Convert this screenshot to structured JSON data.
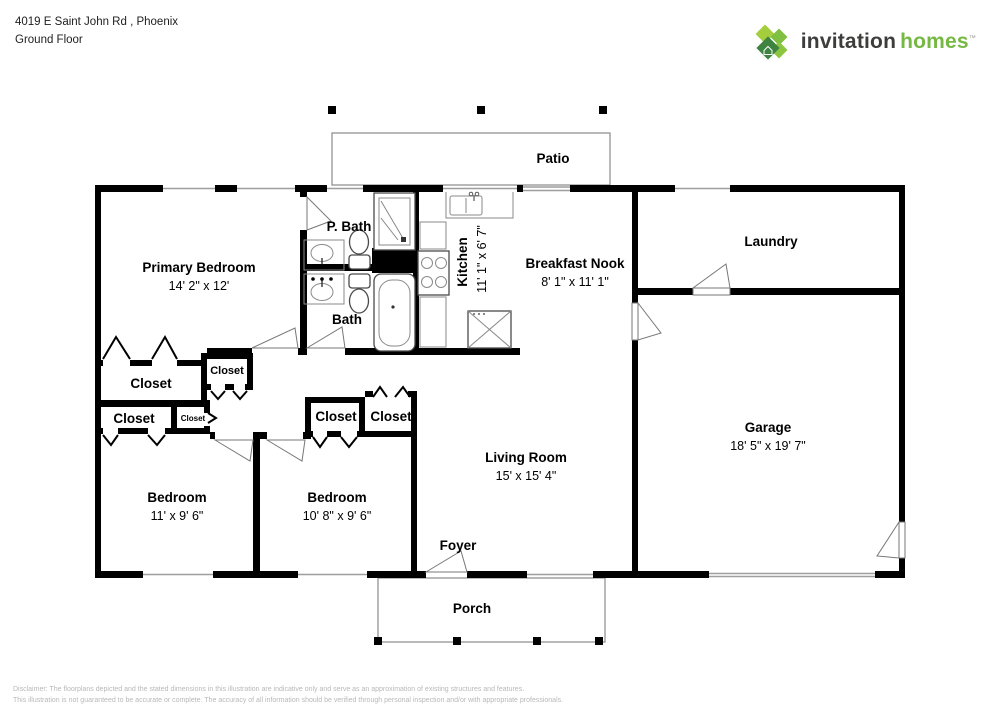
{
  "header": {
    "address_line1": "4019 E Saint John Rd , Phoenix",
    "address_line2": "Ground Floor"
  },
  "brand": {
    "name_part1": "invitation",
    "name_part2": "homes",
    "trademark": "™",
    "color_dark": "#3D3D3C",
    "color_green": "#76B844"
  },
  "plan": {
    "patio": {
      "label": "Patio"
    },
    "primary_bedroom": {
      "label": "Primary Bedroom",
      "dims": "14' 2\" x 12'"
    },
    "p_bath": {
      "label": "P. Bath"
    },
    "bath": {
      "label": "Bath"
    },
    "kitchen": {
      "label": "Kitchen",
      "dims": "11' 1\" x 6' 7\""
    },
    "breakfast_nook": {
      "label": "Breakfast Nook",
      "dims": "8' 1\" x 11' 1\""
    },
    "laundry": {
      "label": "Laundry"
    },
    "garage": {
      "label": "Garage",
      "dims": "18' 5\" x 19' 7\""
    },
    "living_room": {
      "label": "Living Room",
      "dims": "15' x 15' 4\""
    },
    "foyer": {
      "label": "Foyer"
    },
    "bedroom_2": {
      "label": "Bedroom",
      "dims": "11' x 9' 6\""
    },
    "bedroom_3": {
      "label": "Bedroom",
      "dims": "10' 8\" x 9' 6\""
    },
    "closet": {
      "label": "Closet"
    },
    "porch": {
      "label": "Porch"
    }
  },
  "footer": {
    "disclaimer_line1": "Disclaimer: The floorplans depicted and the stated dimensions in this illustration are indicative only and serve as an approximation of existing structures and features.",
    "disclaimer_line2": "This illustration is not guaranteed to be accurate or complete. The accuracy of all information should be verified through personal inspection and/or with appropriate professionals."
  },
  "colors": {
    "wall": "#000000",
    "thin_line": "#8a8a8a",
    "disclaimer_text": "#b8b8b8"
  }
}
